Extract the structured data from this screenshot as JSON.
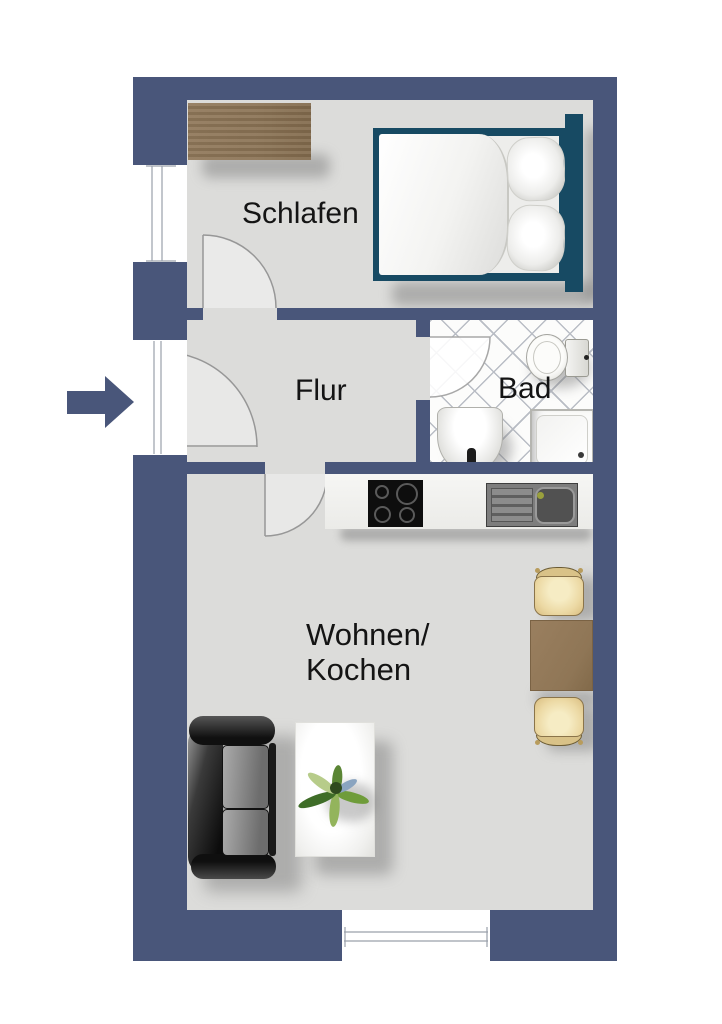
{
  "plan": {
    "rooms": {
      "bedroom": {
        "label": "Schlafen"
      },
      "hallway": {
        "label": "Flur"
      },
      "bathroom": {
        "label": "Bad"
      },
      "living_kitchen": {
        "label_line1": "Wohnen/",
        "label_line2": "Kochen"
      }
    },
    "colors": {
      "wall": "#49567a",
      "floor": "#dcdcda",
      "bathroom_tile_line": "#b9bdc5",
      "bed_frame": "#174a63",
      "wood_light": "#8b7355",
      "dining_table": "#8f7656",
      "chair_seat": "#ecd9a4",
      "sofa_dark": "#222222",
      "label_text": "#141414"
    },
    "icons": [
      "entrance-arrow-icon",
      "wardrobe",
      "double-bed",
      "pillow",
      "duvet",
      "toilet",
      "washbasin",
      "shower",
      "stove",
      "kitchen-sink",
      "dining-table",
      "chair",
      "sofa",
      "coffee-table",
      "plant",
      "window",
      "door-swing"
    ]
  }
}
